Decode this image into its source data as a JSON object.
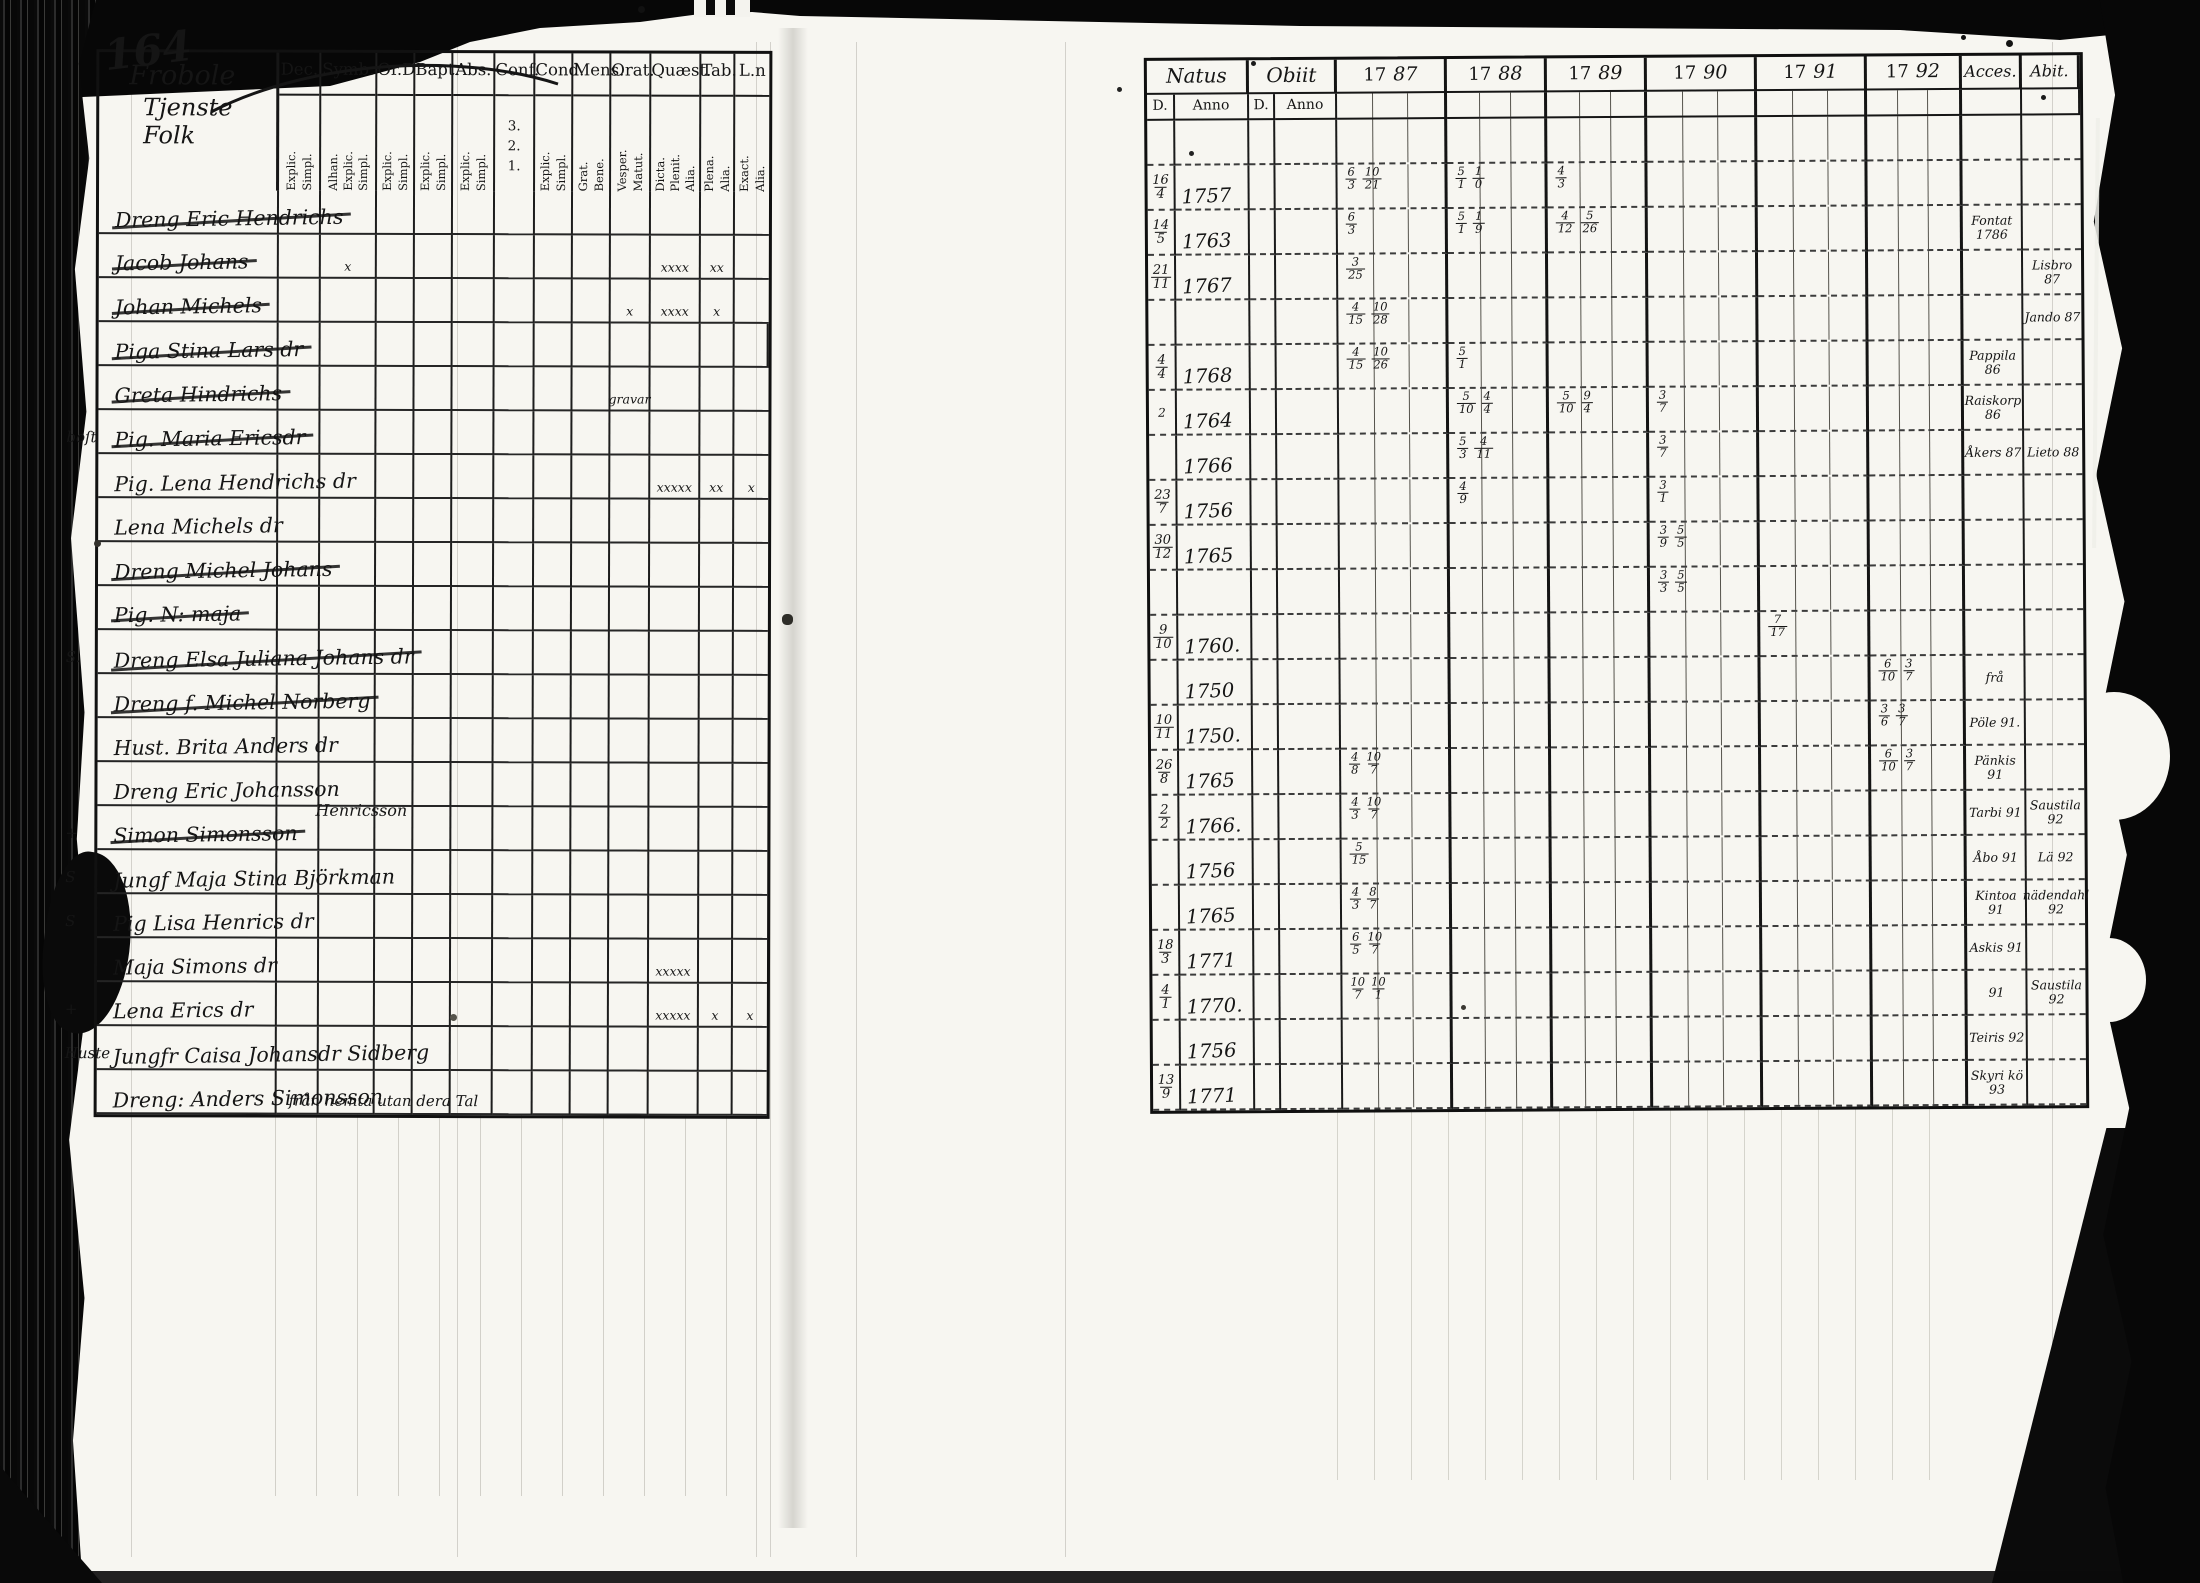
{
  "scan": {
    "page_number": "164"
  },
  "left_page": {
    "title_line1": "Frobole",
    "title_line2": "Tjenste Folk",
    "columns": [
      {
        "label": "Dec.",
        "subs": [
          "Explic.",
          "Simpl."
        ]
      },
      {
        "label": "Symb.",
        "subs": [
          "Alhan.",
          "Explic.",
          "Simpl."
        ]
      },
      {
        "label": "Or.D",
        "subs": [
          "Explic.",
          "Simpl."
        ]
      },
      {
        "label": "Bapt.",
        "subs": [
          "Explic.",
          "Simpl."
        ]
      },
      {
        "label": "Abs.",
        "subs": [
          "Explic.",
          "Simpl."
        ]
      },
      {
        "label": "Conf.",
        "subs": [
          "3.",
          "2.",
          "1."
        ],
        "horizontal": true
      },
      {
        "label": "Cond.",
        "subs": [
          "Explic.",
          "Simpl."
        ]
      },
      {
        "label": "Mens.",
        "subs": [
          "Grat.",
          "Bene."
        ]
      },
      {
        "label": "Orat.",
        "subs": [
          "Vesper.",
          "Matut."
        ]
      },
      {
        "label": "Quæst.",
        "subs": [
          "Dicta.",
          "Plenit.",
          "Alia."
        ]
      },
      {
        "label": "Tab.",
        "subs": [
          "Plena.",
          "Alia."
        ]
      },
      {
        "label": "L.n",
        "subs": [
          "Exact.",
          "Alia."
        ]
      }
    ],
    "rows": [
      {
        "prefix": "",
        "name": "Dreng Eric Hendrichs",
        "struck": true,
        "marks": []
      },
      {
        "prefix": "",
        "name": "Jacob Johans",
        "struck": true,
        "marks": [
          [
            1,
            "x"
          ],
          [
            9,
            "xxxx"
          ],
          [
            10,
            "xx"
          ]
        ]
      },
      {
        "prefix": "",
        "name": "Johan Michels",
        "struck": true,
        "marks": [
          [
            8,
            "x"
          ],
          [
            9,
            "xxxx"
          ],
          [
            10,
            "x"
          ]
        ]
      },
      {
        "prefix": "",
        "name": "Piga Stina Lars dr",
        "struck": true,
        "marks": [],
        "note": "från hemta utan dera Tal"
      },
      {
        "prefix": "",
        "name": "Greta Hindrichs",
        "struck": true,
        "marks": [
          [
            8,
            "gravar"
          ]
        ]
      },
      {
        "prefix": "boſt",
        "name": "Pig. Maria Ericsdr",
        "struck": true,
        "marks": []
      },
      {
        "prefix": "",
        "name": "Pig. Lena Hendrichs dr",
        "struck": false,
        "marks": [
          [
            9,
            "xxxxx"
          ],
          [
            10,
            "xx"
          ],
          [
            11,
            "x"
          ]
        ]
      },
      {
        "prefix": "",
        "name": "Lena Michels dr",
        "struck": false,
        "marks": []
      },
      {
        "prefix": "",
        "name": "Dreng Michel Johans",
        "struck": true,
        "marks": []
      },
      {
        "prefix": "",
        "name": "Pig. N: maja",
        "struck": true,
        "marks": []
      },
      {
        "prefix": "S.",
        "name": "Dreng Elsa Juliana Johans dr",
        "struck": true,
        "marks": []
      },
      {
        "prefix": "",
        "name": "Dreng f. Michel Norberg",
        "struck": true,
        "marks": []
      },
      {
        "prefix": "",
        "name": "Hust. Brita Anders dr",
        "struck": false,
        "marks": []
      },
      {
        "prefix": "",
        "name": "Dreng Eric Johansson",
        "name2": "Henricsson",
        "struck": false,
        "marks": []
      },
      {
        "prefix": "+",
        "name": "Simon Simonsson",
        "struck": true,
        "marks": []
      },
      {
        "prefix": "S",
        "name": "Jungf Maja Stina Björkman",
        "struck": false,
        "marks": []
      },
      {
        "prefix": "S",
        "name": "Pig Lisa Henrics dr",
        "struck": false,
        "marks": []
      },
      {
        "prefix": "",
        "name": "Maja Simons dr",
        "struck": false,
        "marks": [
          [
            9,
            "xxxxx"
          ]
        ]
      },
      {
        "prefix": "+",
        "name": "Lena Erics dr",
        "struck": false,
        "marks": [
          [
            9,
            "xxxxx"
          ],
          [
            10,
            "x"
          ],
          [
            11,
            "x"
          ]
        ]
      },
      {
        "prefix": "Huste",
        "name": "Jungfr Caisa Johansdr Sidberg",
        "struck": false,
        "marks": []
      },
      {
        "prefix": "",
        "name": "Dreng: Anders Simonsson",
        "struck": false,
        "marks": []
      }
    ]
  },
  "right_page": {
    "header": {
      "natus": "Natus",
      "obiit": "Obiit",
      "d": "D.",
      "anno": "Anno",
      "years": [
        {
          "printed": "17",
          "hand": "87"
        },
        {
          "printed": "17",
          "hand": "88"
        },
        {
          "printed": "17",
          "hand": "89"
        },
        {
          "printed": "17",
          "hand": "90"
        },
        {
          "printed": "17",
          "hand": "91"
        },
        {
          "printed": "17",
          "hand": "92"
        }
      ],
      "acce": "Acces.",
      "abit": "Abit."
    },
    "rows": [
      {
        "d": "16/4",
        "anno": "1757",
        "marks": {
          "0": "6/3 10/21",
          "1": "5/1 1/0",
          "2": "4/3"
        },
        "acce": "",
        "abit": ""
      },
      {
        "d": "14/5",
        "anno": "1763",
        "marks": {
          "0": "6/3",
          "1": "5/1 1/9",
          "2": "4/12 5/26"
        },
        "acce": "Fontat 1786",
        "abit": ""
      },
      {
        "d": "21/11",
        "anno": "1767",
        "marks": {
          "0": "3/25"
        },
        "acce": "",
        "abit": "Lisbro 87"
      },
      {
        "d": "",
        "anno": "",
        "marks": {
          "0": "4/15 10/28"
        },
        "acce": "",
        "abit": "Jando 87"
      },
      {
        "d": "4/4",
        "anno": "1768",
        "marks": {
          "0": "4/15 10/26",
          "1": "5/1"
        },
        "acce": "Pappila 86",
        "abit": ""
      },
      {
        "d": "2",
        "anno": "1764",
        "marks": {
          "1": "5/10 4/4",
          "2": "5/10 9/4",
          "3": "3/7"
        },
        "acce": "Raiskorp 86",
        "abit": ""
      },
      {
        "d": "",
        "anno": "1766",
        "marks": {
          "1": "5/3 4/11",
          "3": "3/7"
        },
        "acce": "Åkers 87",
        "abit": "Lieto 88"
      },
      {
        "d": "23/7",
        "anno": "1756",
        "marks": {
          "1": "4/9",
          "3": "3/1"
        },
        "acce": "",
        "abit": ""
      },
      {
        "d": "30/12",
        "anno": "1765",
        "marks": {
          "3": "3/9 5/5"
        },
        "acce": "",
        "abit": ""
      },
      {
        "d": "",
        "anno": "",
        "marks": {
          "3": "3/3 5/5"
        },
        "acce": "",
        "abit": ""
      },
      {
        "d": "9/10",
        "anno": "1760.",
        "marks": {
          "4": "7/17"
        },
        "acce": "",
        "abit": ""
      },
      {
        "d": "",
        "anno": "1750",
        "marks": {
          "5": "6/10 3/7"
        },
        "acce": "frå",
        "abit": ""
      },
      {
        "d": "10/11",
        "anno": "1750.",
        "marks": {
          "5": "3/6 3/7"
        },
        "acce": "Pöle 91.",
        "abit": ""
      },
      {
        "d": "26/8",
        "anno": "1765",
        "marks": {
          "0": "4/8 10/7",
          "5": "6/10 3/7"
        },
        "acce": "Pänkis 91",
        "abit": ""
      },
      {
        "d": "2/2",
        "anno": "1766.",
        "marks": {
          "0": "4/3 10/7"
        },
        "acce": "Tarbi 91",
        "abit": "Saustila 92"
      },
      {
        "d": "",
        "anno": "1756",
        "marks": {
          "0": "5/15"
        },
        "acce": "Åbo 91",
        "abit": "Lä 92"
      },
      {
        "d": "",
        "anno": "1765",
        "marks": {
          "0": "4/3 8/7"
        },
        "acce": "Kintoa 91",
        "abit": "nädendahl 92"
      },
      {
        "d": "18/3",
        "anno": "1771",
        "marks": {
          "0": "6/5 10/7"
        },
        "acce": "Askis 91",
        "abit": ""
      },
      {
        "d": "4/1",
        "anno": "1770.",
        "marks": {
          "0": "10/7 10/1"
        },
        "acce": "91",
        "abit": "Saustila 92"
      },
      {
        "d": "",
        "anno": "1756",
        "marks": {},
        "acce": "Teiris 92",
        "abit": ""
      },
      {
        "d": "13/9",
        "anno": "1771",
        "marks": {},
        "acce": "Skyri kö 93",
        "abit": ""
      }
    ]
  }
}
